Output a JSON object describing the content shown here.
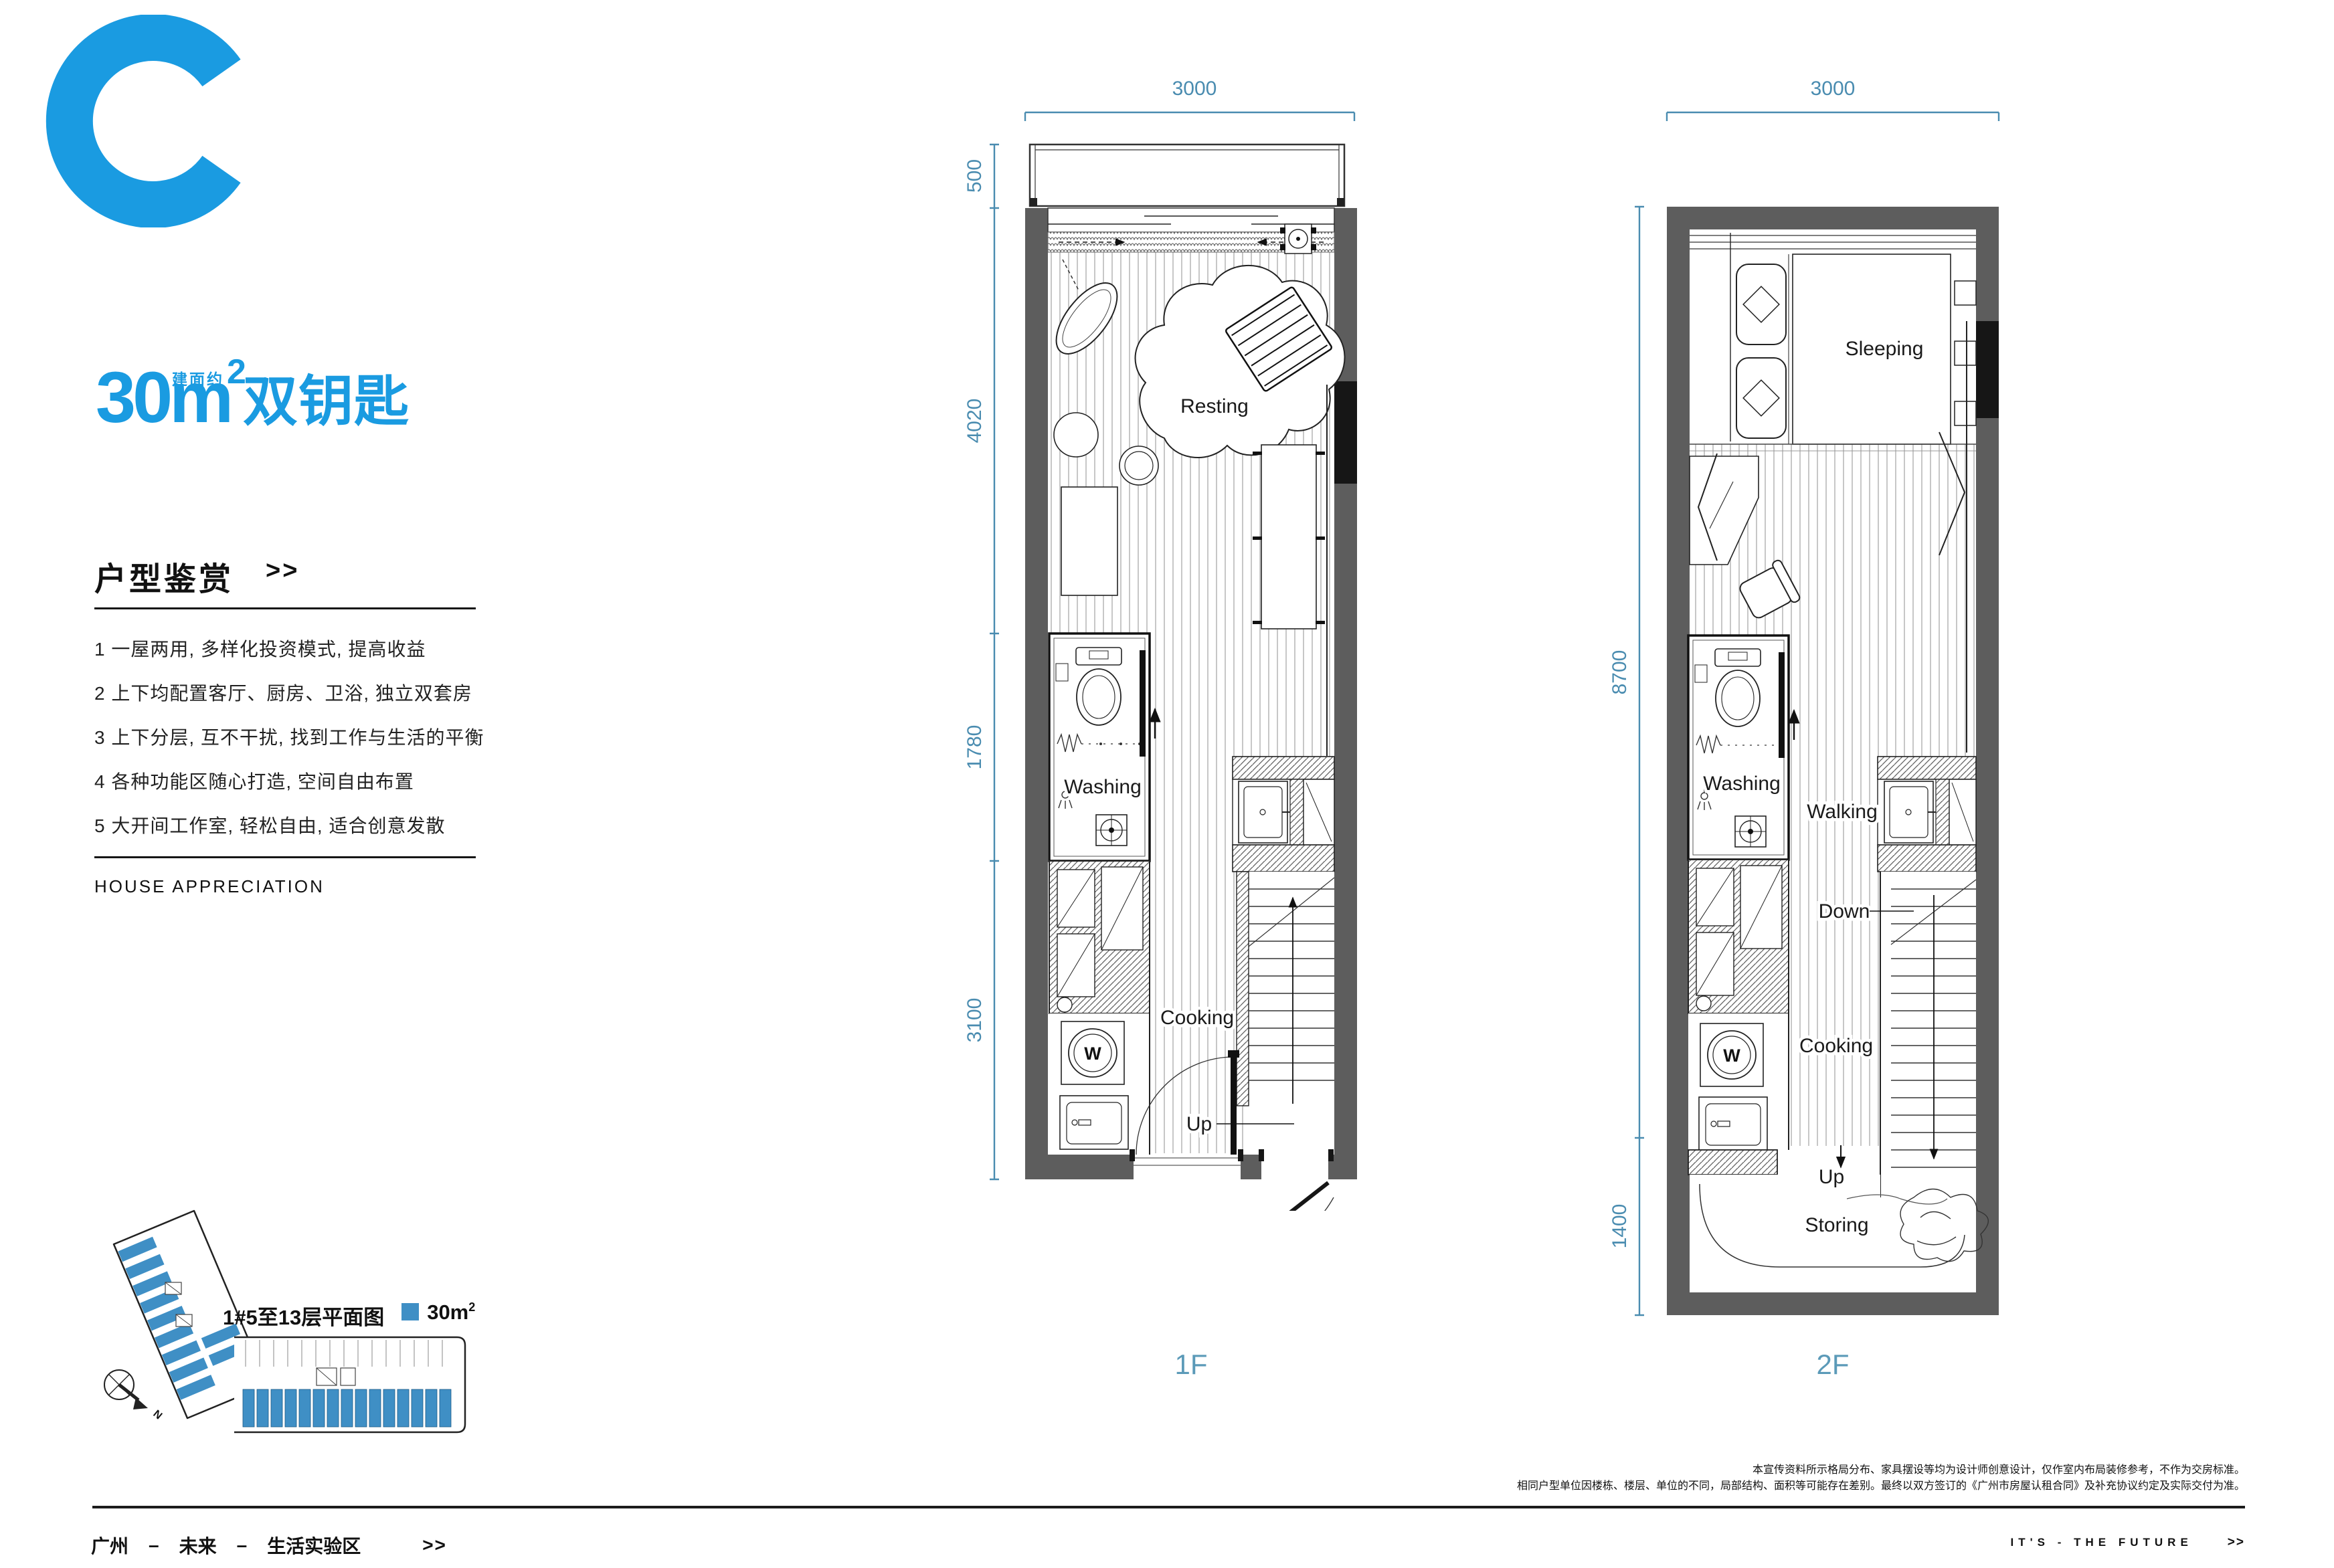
{
  "colors": {
    "accent_bright": "#1a9be1",
    "accent_dim": "#4a8cb0",
    "floor_label": "#5b9ab8",
    "plate_unit": "#3f8fc5",
    "wall": "#5d5d5d"
  },
  "header": {
    "type_letter": "C",
    "area_number": "30m",
    "area_sup": "2",
    "area_prefix": "建面约",
    "subtitle": "双钥匙"
  },
  "appreciation": {
    "title": "户型鉴赏",
    "arrows": ">>",
    "items": [
      "1 一屋两用, 多样化投资模式, 提高收益",
      "2 上下均配置客厅、厨房、卫浴, 独立双套房",
      "3 上下分层, 互不干扰, 找到工作与生活的平衡",
      "4 各种功能区随心打造, 空间自由布置",
      "5 大开间工作室, 轻松自由, 适合创意发散"
    ],
    "subtitle_en": "HOUSE APPRECIATION"
  },
  "plate": {
    "caption": "1#5至13层平面图",
    "legend_value": "30m",
    "legend_sup": "2",
    "compass_n": "N"
  },
  "floor1": {
    "label": "1F",
    "dim_top": "3000",
    "left_dims": [
      "500",
      "4020",
      "1780",
      "3100"
    ],
    "room_resting": "Resting",
    "room_washing": "Washing",
    "room_cooking": "Cooking",
    "room_up": "Up",
    "washer": "W"
  },
  "floor2": {
    "label": "2F",
    "dim_top": "3000",
    "left_dims": [
      "8700",
      "1400"
    ],
    "room_sleeping": "Sleeping",
    "room_washing": "Washing",
    "room_walking": "Walking",
    "room_down": "Down",
    "room_cooking": "Cooking",
    "room_up": "Up",
    "room_storing": "Storing",
    "washer": "W"
  },
  "disclaimer": {
    "line1": "本宣传资料所示格局分布、家具摆设等均为设计师创意设计，仅作室内布局装修参考，不作为交房标准。",
    "line2": "相同户型单位因楼栋、楼层、单位的不同，局部结构、面积等可能存在差别。最终以双方签订的《广州市房屋认租合同》及补充协议约定及实际交付为准。"
  },
  "footer": {
    "left_city": "广州",
    "left_dash1": "–",
    "left_mid": "未来",
    "left_dash2": "–",
    "left_area": "生活实验区",
    "left_arrows": ">>",
    "right_text": "IT'S - THE FUTURE",
    "right_arrows": ">>"
  }
}
